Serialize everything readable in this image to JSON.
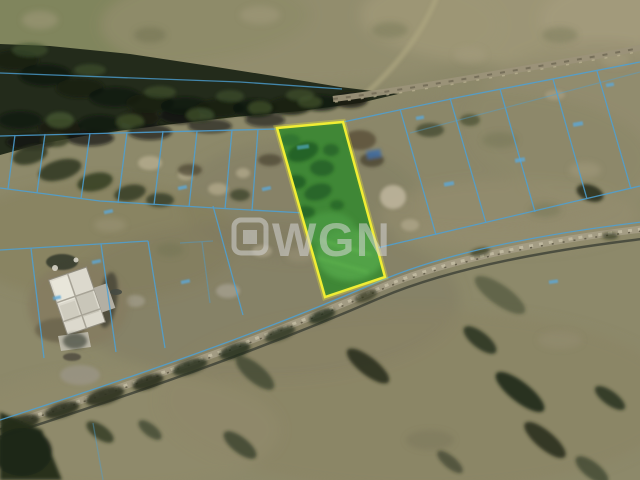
{
  "watermark": {
    "logo_text": "WGN",
    "icon": "wgn-square-logo-icon"
  },
  "colors": {
    "plot_outline": "#f1ee2d",
    "plot_fill": "#35882e",
    "cadastral_lines": "#4aa2d9",
    "watermark": "#d4d4d4"
  }
}
